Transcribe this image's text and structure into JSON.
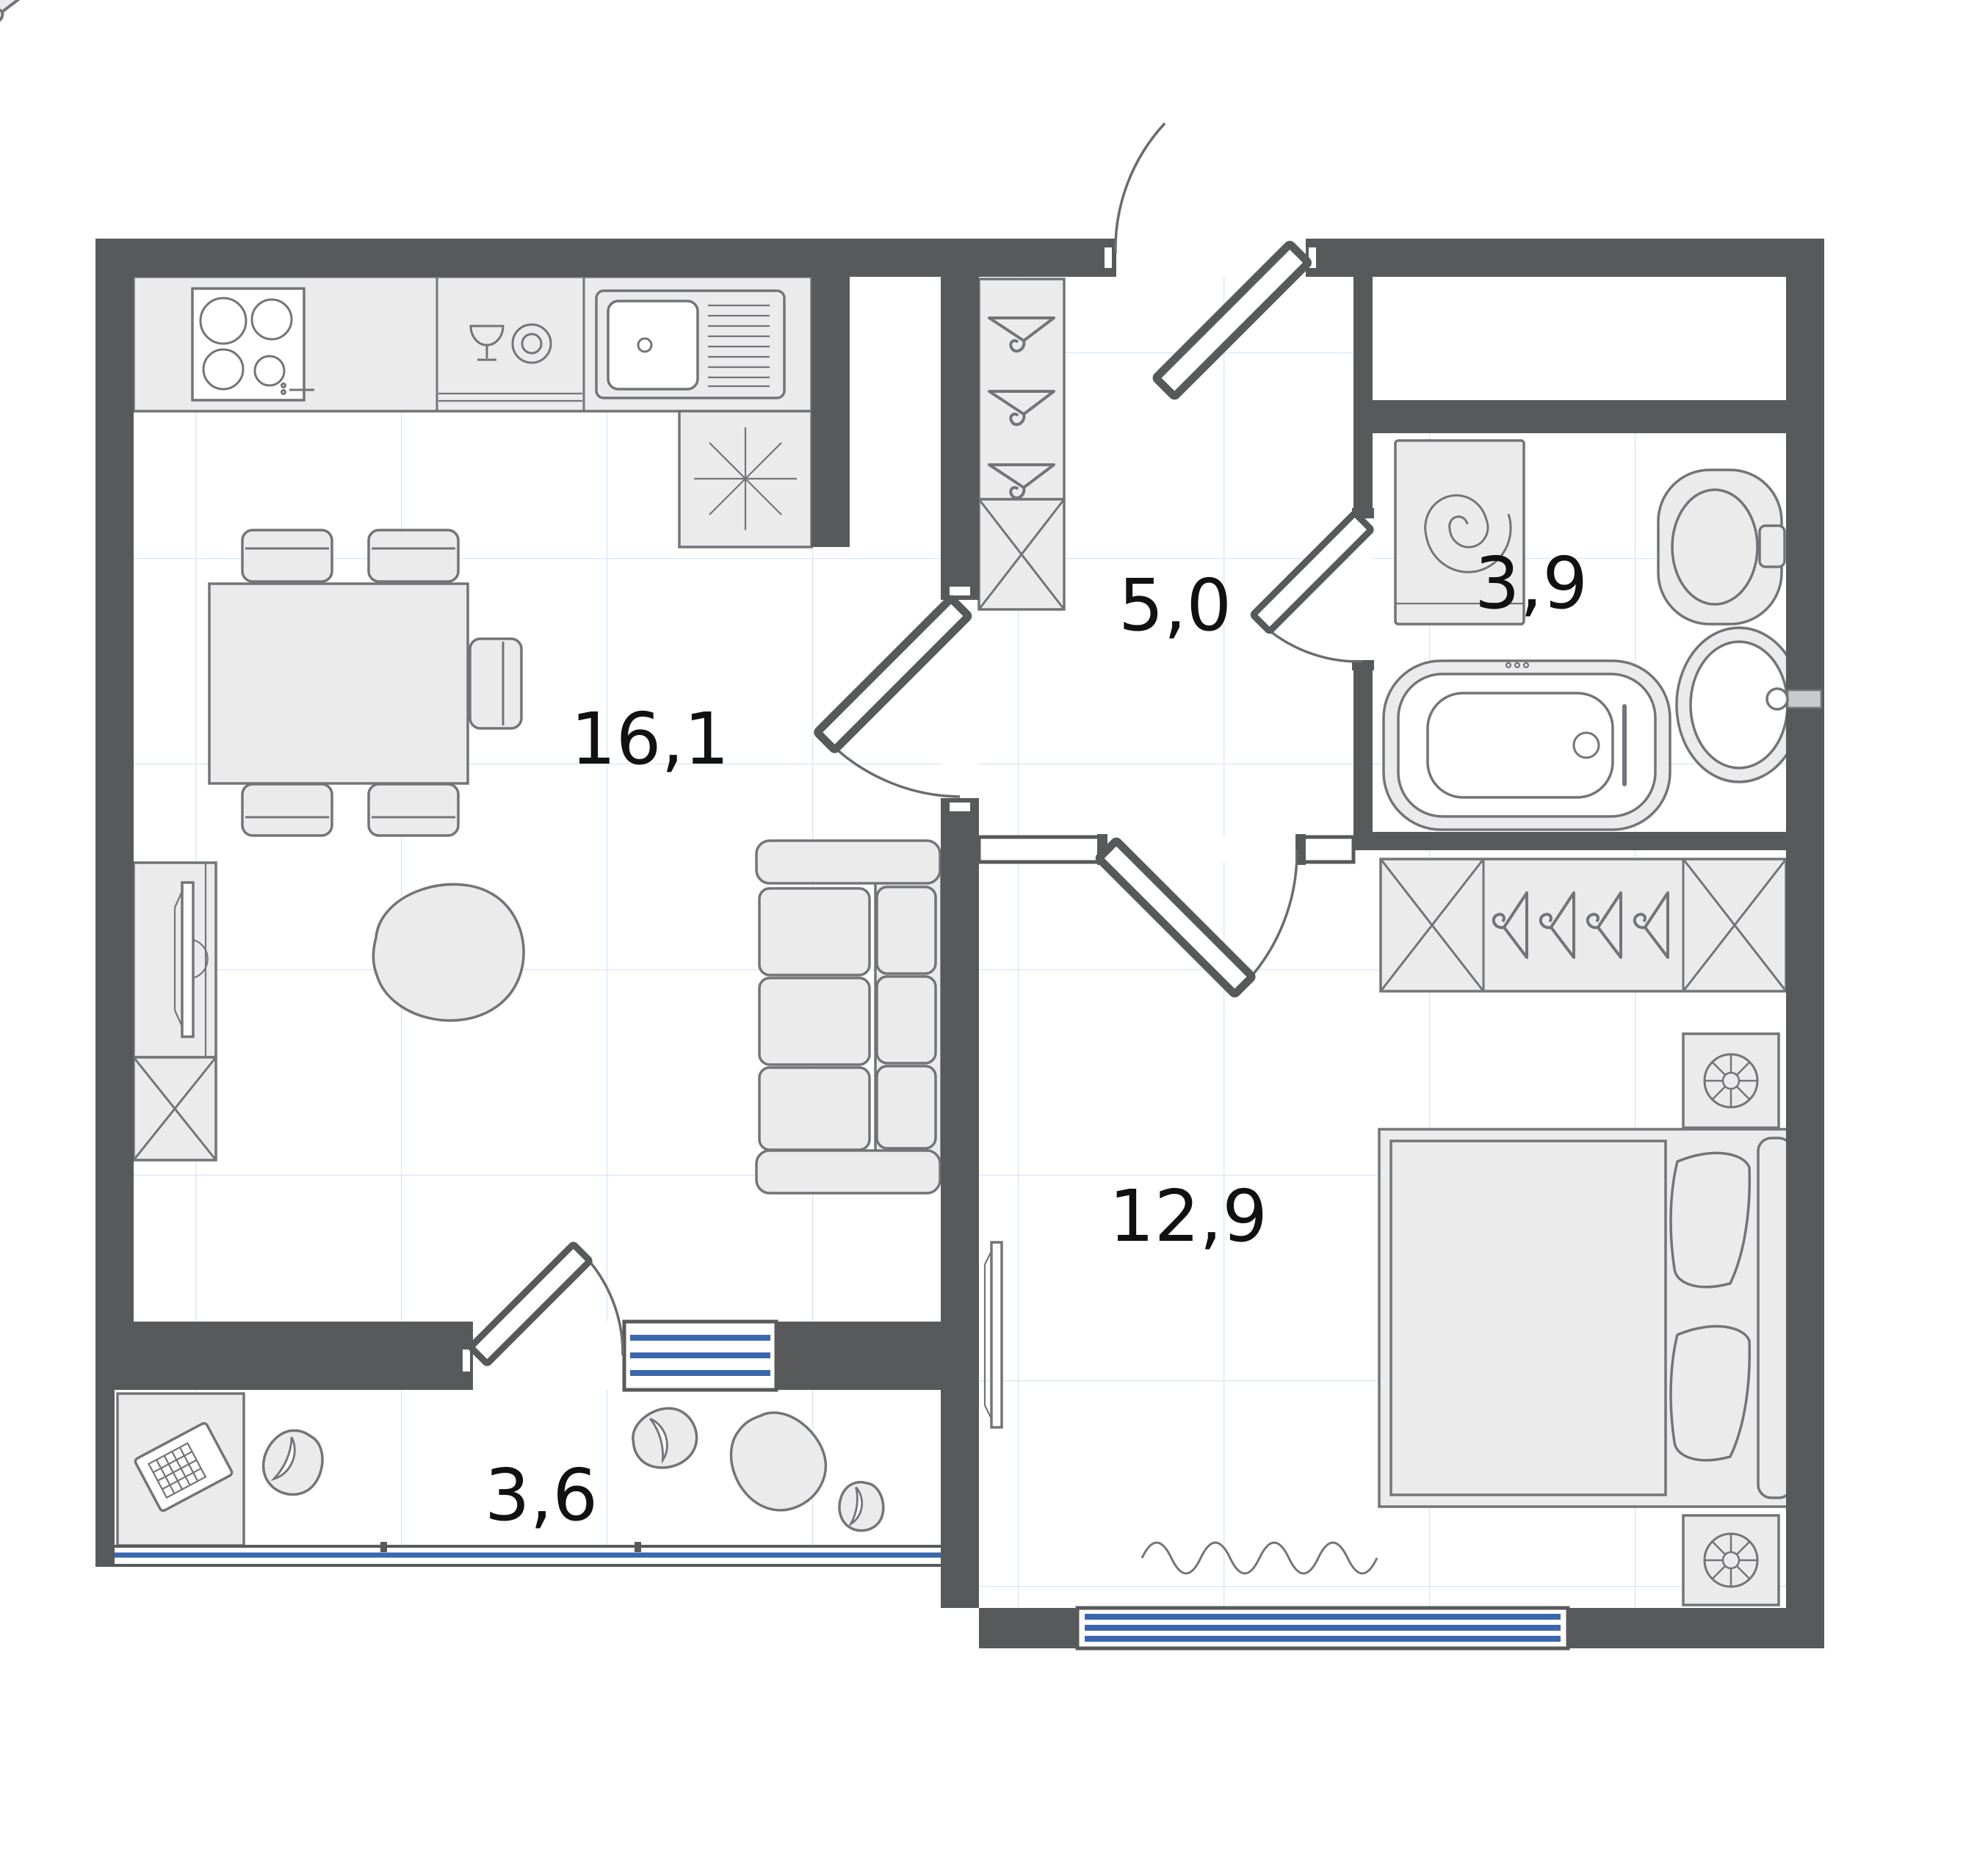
{
  "plan": {
    "type": "apartment-floor-plan",
    "rooms": [
      {
        "id": "living-kitchen",
        "area": "16,1"
      },
      {
        "id": "hallway",
        "area": "5,0"
      },
      {
        "id": "bathroom",
        "area": "3,9"
      },
      {
        "id": "bedroom",
        "area": "12,9"
      },
      {
        "id": "balcony",
        "area": "3,6"
      }
    ],
    "colors": {
      "wall": "#58595b",
      "furn_fill": "#ebebec",
      "furn_stroke": "#737477",
      "grid": "#d8e6f5",
      "glazing": "#3a67ad",
      "floor": "#ffffff",
      "label": "#111111"
    },
    "icons": [
      "stove-icon",
      "dishwasher-icon",
      "kitchen-sink-icon",
      "asterisk-unit-icon",
      "dining-table",
      "dining-chair",
      "tv-icon",
      "cabinet-x-icon",
      "sofa",
      "coffee-table",
      "coat-hanger-icon",
      "wardrobe",
      "washing-machine-icon",
      "toilet-icon",
      "washbasin-icon",
      "bathtub-icon",
      "double-bed",
      "pillow",
      "nightstand-lamp-icon",
      "desk",
      "laptop-icon",
      "pouf-armchair",
      "curtain-icon",
      "door-swing",
      "window-glazing",
      "radiator-window"
    ]
  }
}
